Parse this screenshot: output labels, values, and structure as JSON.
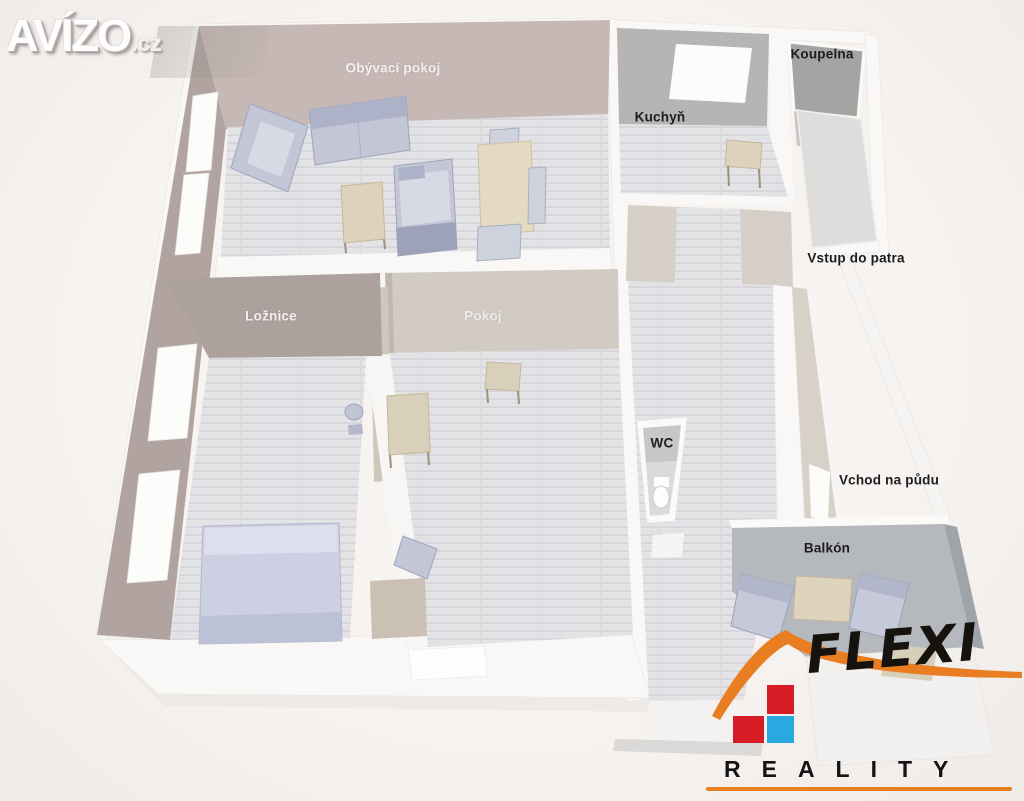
{
  "watermark": {
    "name": "AVÍZO",
    "tld": ".cz"
  },
  "floorplan": {
    "rooms": [
      {
        "id": "obyvaci-pokoj",
        "label": "Obývací pokoj",
        "label_style": "light"
      },
      {
        "id": "kuchyn",
        "label": "Kuchyň",
        "label_style": "dark"
      },
      {
        "id": "koupelna",
        "label": "Koupelna",
        "label_style": "dark"
      },
      {
        "id": "vstup-do-patra",
        "label": "Vstup do patra",
        "label_style": "dark"
      },
      {
        "id": "loznice",
        "label": "Ložnice",
        "label_style": "light"
      },
      {
        "id": "pokoj",
        "label": "Pokoj",
        "label_style": "light"
      },
      {
        "id": "wc",
        "label": "WC",
        "label_style": "dark"
      },
      {
        "id": "vchod-na-pudu",
        "label": "Vchod na půdu",
        "label_style": "dark"
      },
      {
        "id": "balkon",
        "label": "Balkón",
        "label_style": "dark"
      }
    ],
    "furniture": [
      "armchair",
      "sofa",
      "corner-sofa",
      "coffee-table",
      "dining-table",
      "dining-chairs",
      "kitchen-table",
      "bed",
      "office-chair",
      "desk",
      "desk-chair",
      "cabinet",
      "balcony-chairs",
      "balcony-table",
      "side-table",
      "toilet"
    ]
  },
  "agency_logo": {
    "name": "FLEXI",
    "subtitle": "REALITY"
  },
  "colors": {
    "background": "#f5f1ee",
    "wall_mauve": "#c6b9b5",
    "wall_mauve_dark": "#aca19c",
    "wall_gray": "#b7b5b3",
    "wall_beige": "#d6cfc7",
    "wall_white": "#f9f8f6",
    "floor_plank": "#e3e2e5",
    "furniture_blue": "#c5c8d8",
    "table_beige": "#ddd3bc",
    "balcony_gray": "#b5b9bd",
    "logo_orange": "#e87d22",
    "logo_red": "#d61c24",
    "logo_blue": "#2aa9e0",
    "label_dark": "#1d1d1f",
    "label_light": "#f3eff0"
  }
}
